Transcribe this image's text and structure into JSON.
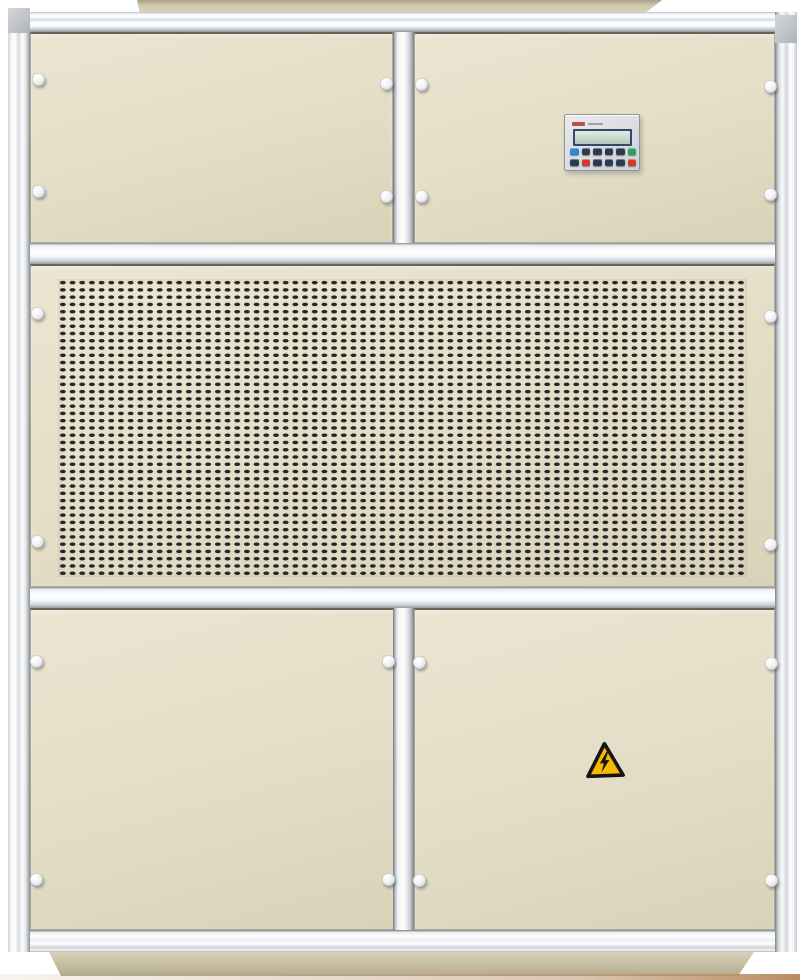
{
  "meta": {
    "title": "Industrial air handling unit cabinet",
    "description": "Front view of a beige industrial HVAC air handling unit with silver aluminum frame, two upper access panels, an embedded controller with LCD and keypad, a large perforated ventilation grille, two lower doors, a high-voltage warning sticker and a beige base plinth"
  },
  "palette": {
    "bg": "#ffffff",
    "panel-cream": "#e4ddc6",
    "panel-cream-light": "#ebe5d2",
    "panel-cream-dark": "#d9d2b8",
    "slot-dark": "#23272c",
    "corner-gray": "#c6cacf",
    "plinth-beige": "#cdc5aa",
    "floor-warm": "#b98d62",
    "lcd-frame": "#35486b",
    "lcd-screen": "#cfdfd2",
    "btn-dark": "#2c3950",
    "btn-blue": "#2e86d6",
    "btn-green": "#27a35a",
    "btn-red": "#cf3a2c",
    "brand-red": "#b5352a",
    "warning-yellow": "#f6b800",
    "warning-black": "#151515"
  },
  "unit": {
    "sections": [
      "top-left-panel",
      "top-right-panel",
      "ventilation-grille",
      "bottom-left-door",
      "bottom-right-door"
    ],
    "knobs": [
      [
        38,
        79
      ],
      [
        38,
        191
      ],
      [
        386,
        83
      ],
      [
        386,
        196
      ],
      [
        421,
        84
      ],
      [
        421,
        196
      ],
      [
        770,
        86
      ],
      [
        770,
        194
      ],
      [
        37,
        313
      ],
      [
        37,
        541
      ],
      [
        770,
        316
      ],
      [
        770,
        544
      ],
      [
        36,
        661
      ],
      [
        36,
        879
      ],
      [
        388,
        661
      ],
      [
        388,
        879
      ],
      [
        419,
        662
      ],
      [
        419,
        880
      ],
      [
        771,
        663
      ],
      [
        771,
        880
      ]
    ]
  },
  "grille": {
    "cols": 71,
    "rows": 41,
    "pitch_x": 9.7,
    "pitch_y": 7.27,
    "slot_width": 6.2,
    "slot_height": 3.7
  },
  "controller": {
    "display_text": "",
    "button_rows": [
      [
        "blue",
        "dark",
        "dark",
        "dark",
        "dark",
        "green"
      ],
      [
        "dark",
        "red",
        "dark",
        "dark",
        "dark",
        "red"
      ]
    ]
  },
  "warning": {
    "symbol": "high-voltage-lightning",
    "shape": "triangle"
  }
}
